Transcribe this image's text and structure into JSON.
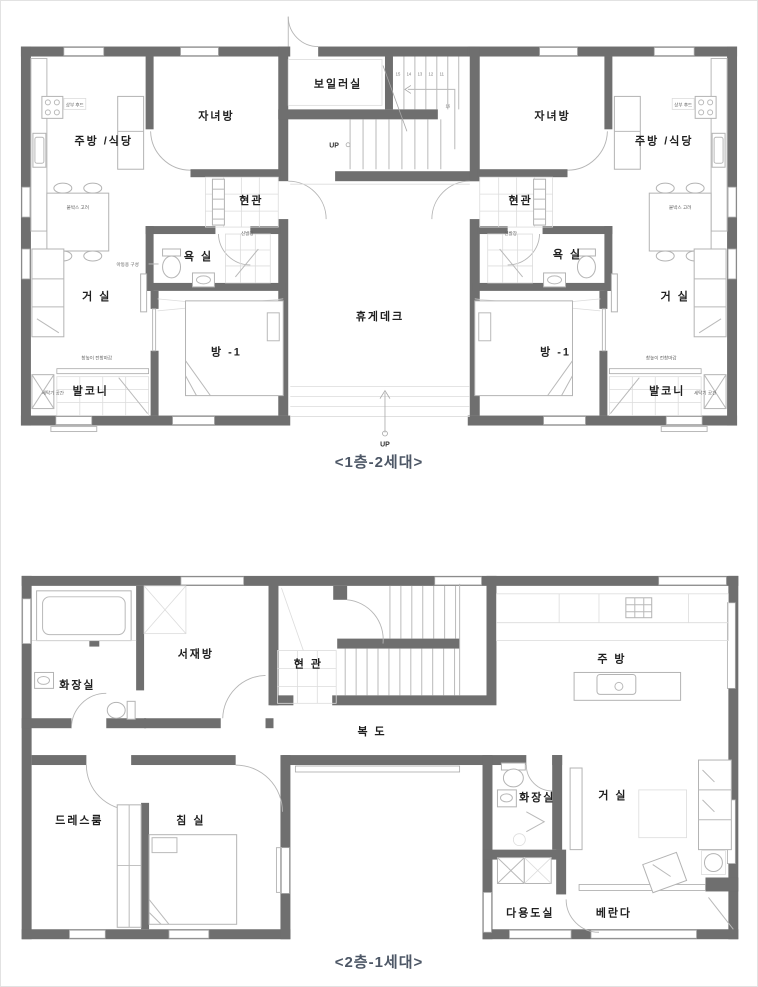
{
  "colors": {
    "wall": "#6f6f6f",
    "hairline": "#b9b9b9",
    "caption_text": "#4d5766",
    "label_text": "#1f1f1f",
    "background": "#ffffff"
  },
  "floor1": {
    "caption": "<1층-2세대>",
    "labels": {
      "kitchen_left": "주방 /식당",
      "kids_left": "자녀방",
      "boiler": "보일러실",
      "entrance_left": "현관",
      "shoe_left": "신발장",
      "bath_left": "욕 실",
      "living_left": "거 실",
      "room1_left": "방 -1",
      "balcony_left": "발코니",
      "laundry_left": "세탁기 공간",
      "deck": "휴게데크",
      "kids_right": "자녀방",
      "kitchen_right": "주방 /식당",
      "entrance_right": "현관",
      "shoe_right": "신발장",
      "bath_right": "욕 실",
      "living_right": "거 실",
      "room1_right": "방 -1",
      "balcony_right": "발코니",
      "laundry_right": "세탁기 공간"
    },
    "stairs": {
      "up_label": "UP",
      "numbers": [
        "15",
        "14",
        "13",
        "12",
        "11"
      ],
      "landing_number": "16"
    },
    "deck_up_label": "UP",
    "annotations": {
      "hood": "상부 후드",
      "kids_config": "아동용 구성",
      "window_finish": "창높이 전창마감",
      "table_note": "붙박스 고려"
    }
  },
  "floor2": {
    "caption": "<2층-1세대>",
    "labels": {
      "toilet_upper": "화장실",
      "study": "서재방",
      "entrance": "현 관",
      "corridor": "복 도",
      "kitchen": "주 방",
      "dressroom": "드레스룸",
      "bedroom": "침 실",
      "toilet_lower": "화장실",
      "living": "거 실",
      "utility": "다용도실",
      "veranda": "베란다"
    }
  }
}
